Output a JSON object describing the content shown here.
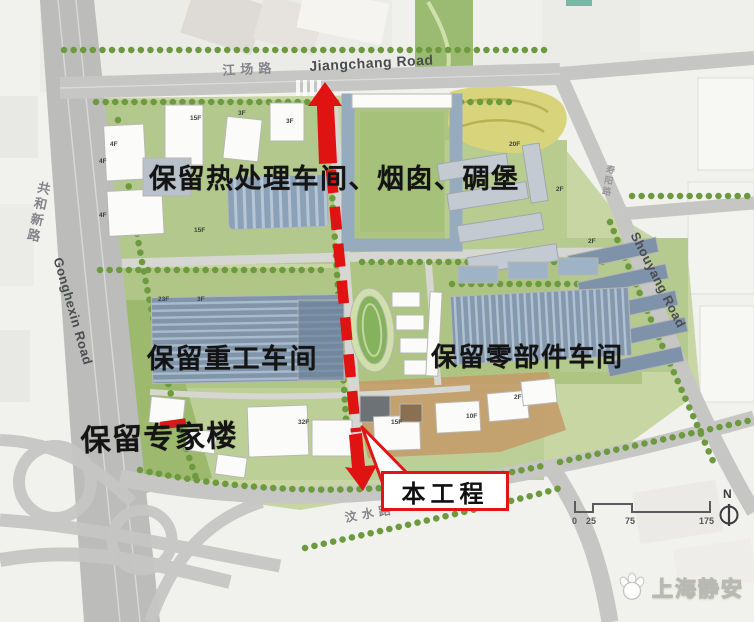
{
  "figure": {
    "roads": {
      "jiangchang_cn": "江场路",
      "jiangchang_en": "Jiangchang Road",
      "gonghexin_cn": "共和新路",
      "gonghexin_en": "Gonghexin Road",
      "shouyang_cn": "寿阳路",
      "shouyang_en": "Shouyang Road",
      "wenshui_cn": "汶水路",
      "wenshui_en_fragment": "oad"
    },
    "annotations": [
      {
        "text": "保留热处理车间、烟囱、碉堡"
      },
      {
        "text": "保留重工车间"
      },
      {
        "text": "保留零部件车间"
      },
      {
        "text": "保留专家楼"
      }
    ],
    "callout": {
      "label": "本工程"
    },
    "floor_labels": [
      {
        "text": "4F",
        "x": 110,
        "y": 141
      },
      {
        "text": "15F",
        "x": 190,
        "y": 115
      },
      {
        "text": "3F",
        "x": 238,
        "y": 110
      },
      {
        "text": "3F",
        "x": 286,
        "y": 118
      },
      {
        "text": "4F",
        "x": 99,
        "y": 158
      },
      {
        "text": "4F",
        "x": 99,
        "y": 212
      },
      {
        "text": "15F",
        "x": 194,
        "y": 227
      },
      {
        "text": "23F",
        "x": 158,
        "y": 296
      },
      {
        "text": "3F",
        "x": 197,
        "y": 296
      },
      {
        "text": "32F",
        "x": 298,
        "y": 419
      },
      {
        "text": "15F",
        "x": 391,
        "y": 419
      },
      {
        "text": "10F",
        "x": 466,
        "y": 413
      },
      {
        "text": "2F",
        "x": 514,
        "y": 394
      },
      {
        "text": "20F",
        "x": 509,
        "y": 141
      },
      {
        "text": "2F",
        "x": 556,
        "y": 186
      },
      {
        "text": "2F",
        "x": 588,
        "y": 238
      }
    ],
    "scale_bar": {
      "ticks": [
        "0",
        "25",
        "75",
        "175"
      ]
    },
    "compass": {
      "north_label": "N"
    },
    "logo": {
      "text": "上海静安",
      "icon": "magnolia-flower-icon"
    }
  },
  "colors": {
    "accent_red": "#e01313",
    "road_gray": "#c6c6c4",
    "site_green": "#c7d6a2",
    "roof_blue": "#8599ae",
    "annotation_black": "#141414"
  }
}
